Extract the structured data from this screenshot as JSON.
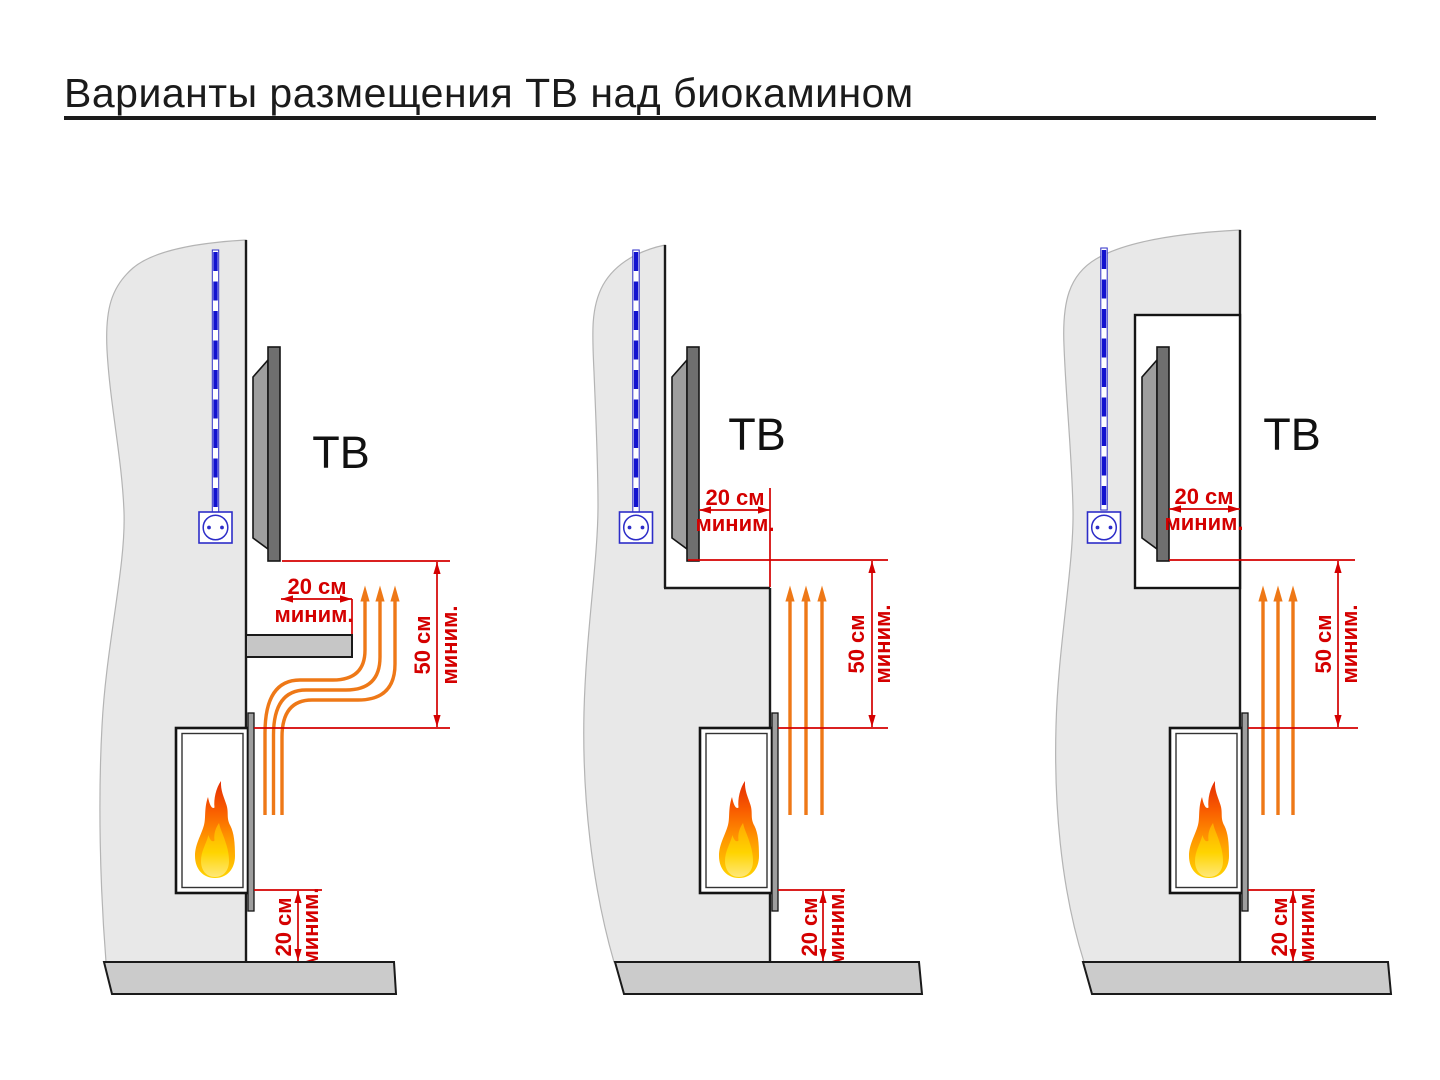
{
  "title": "Варианты размещения ТВ над биокамином",
  "labels": {
    "tv": "ТВ",
    "cm20": "20 см",
    "cm50": "50 см",
    "min": "миним."
  },
  "colors": {
    "dimension_red": "#d40000",
    "heat_orange": "#ee7817",
    "cable_blue": "#1212cf",
    "outlet_blue": "#2d2dc8",
    "wall_gray": "#e8e8e8",
    "floor_gray": "#cbcbcb",
    "tv_panel_gray": "#6f6f6f",
    "tv_back_gray": "#9e9e9e",
    "flame_top_red": "#e32d04",
    "flame_bottom_yellow": "#ffd400"
  }
}
